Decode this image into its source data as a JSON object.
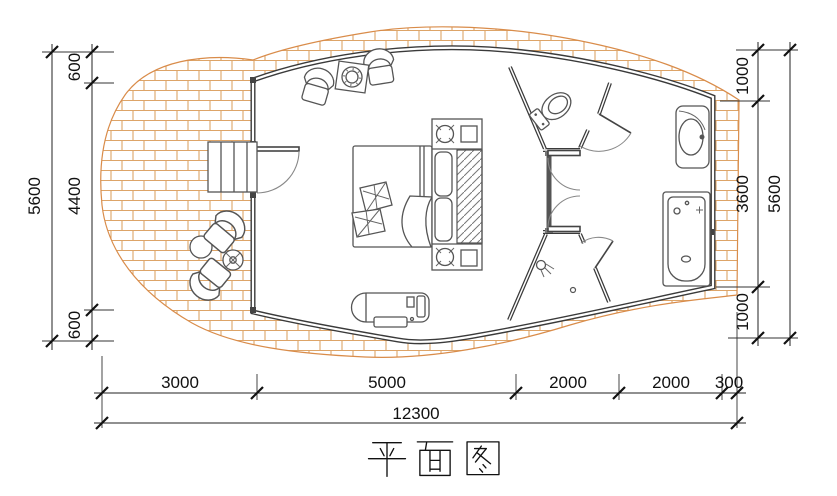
{
  "title": {
    "text": "平面图"
  },
  "dimensions": {
    "left": {
      "total": "5600",
      "segments": [
        "600",
        "4400",
        "600"
      ]
    },
    "right": {
      "total": "5600",
      "segments": [
        "1000",
        "3600",
        "1000"
      ]
    },
    "bottom": {
      "total": "12300",
      "segments": [
        "3000",
        "5000",
        "2000",
        "2000",
        "300"
      ]
    }
  },
  "plan": {
    "areas": [
      "terrace",
      "bedroom",
      "toilet-room",
      "shower-room",
      "bathroom"
    ],
    "fixture_icons": [
      "stairs-icon",
      "door-swing-icon",
      "armchair-icon",
      "side-table-icon",
      "double-bed-icon",
      "pillow-icon",
      "lamp-icon",
      "wardrobe-icon",
      "bench-icon",
      "toilet-icon",
      "shower-head-icon",
      "floor-drain-icon",
      "washbasin-icon",
      "bathtub-icon",
      "round-table-icon",
      "plant-icon"
    ]
  },
  "colors": {
    "background": "#ffffff",
    "brick_hatch": "#dda468",
    "site_outline": "#d98c4a",
    "wall": "#3a3a3a",
    "fixture_line": "#555555",
    "dimension_line": "#1a1a1a"
  }
}
